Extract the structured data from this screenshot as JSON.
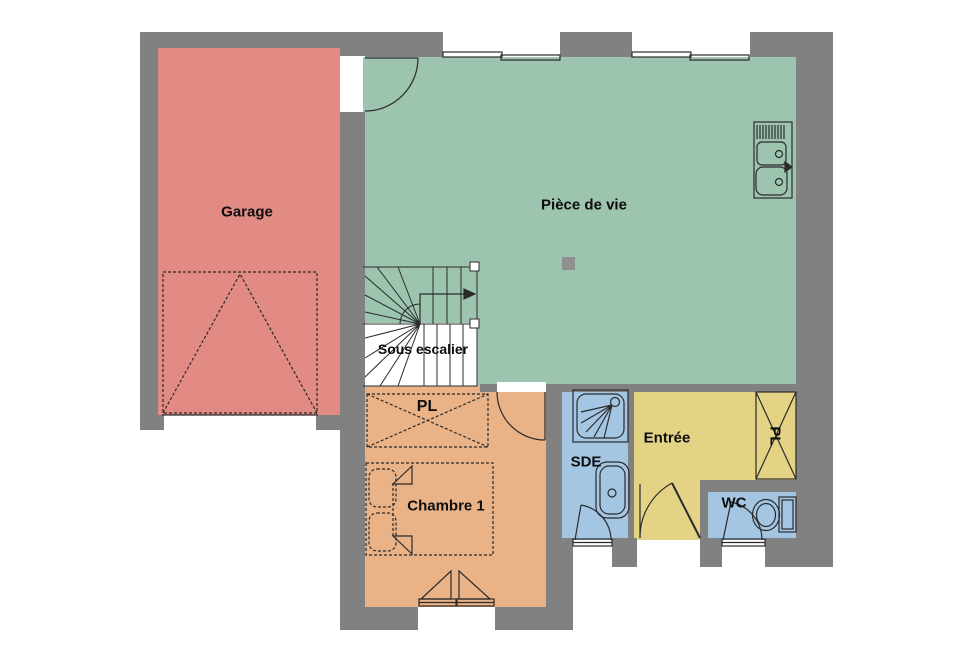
{
  "plan": {
    "title": "Rez-de-chaussée floor plan",
    "wall_color": "#818181",
    "post_color": "#8F8F8F",
    "line_color": "#2B2B2B",
    "opening_color": "#FFFFFF",
    "rooms": [
      {
        "id": "garage",
        "label": "Garage",
        "color": "#E28B85"
      },
      {
        "id": "living",
        "label": "Pièce de vie",
        "color": "#9CC4AE"
      },
      {
        "id": "under-stairs",
        "label": "Sous escalier",
        "color": "#FFFFFF"
      },
      {
        "id": "bedroom-closet",
        "label": "PL",
        "color": "#E9B287"
      },
      {
        "id": "bedroom",
        "label": "Chambre 1",
        "color": "#E9B287"
      },
      {
        "id": "shower-room",
        "label": "SDE",
        "color": "#A4C6E3"
      },
      {
        "id": "entry",
        "label": "Entrée",
        "color": "#E5D385"
      },
      {
        "id": "entry-closet",
        "label": "PL",
        "color": "#E5D385"
      },
      {
        "id": "wc",
        "label": "WC",
        "color": "#A4C6E3"
      }
    ],
    "fixtures": [
      {
        "id": "kitchen-sink"
      },
      {
        "id": "shower"
      },
      {
        "id": "washbasin"
      },
      {
        "id": "toilet"
      },
      {
        "id": "double-bed"
      },
      {
        "id": "winder-staircase"
      },
      {
        "id": "garage-door"
      },
      {
        "id": "closet-cross-bedroom"
      },
      {
        "id": "closet-cross-entry"
      }
    ]
  }
}
